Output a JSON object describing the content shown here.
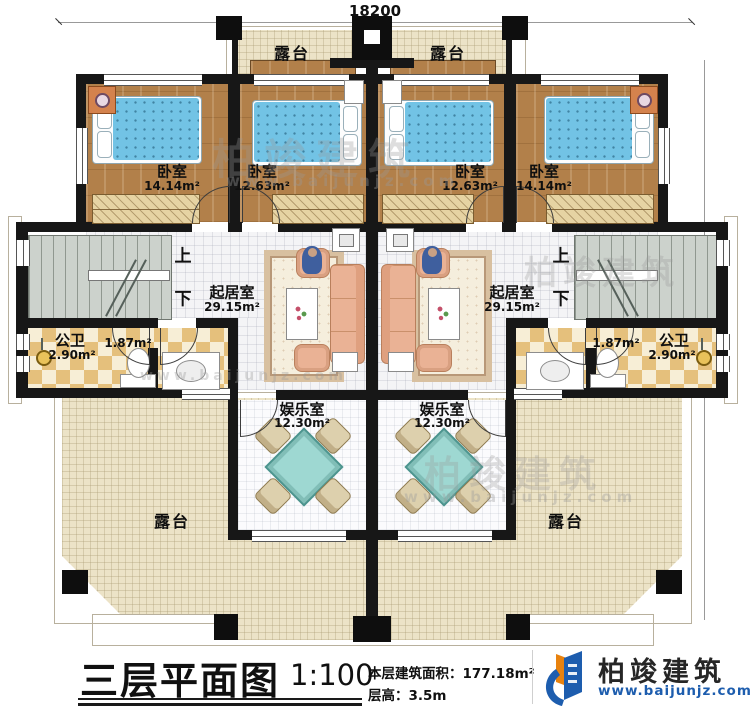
{
  "plan": {
    "dimensions": {
      "width_top": "18200",
      "height_right": "15840"
    },
    "stairs": {
      "up": "上",
      "down": "下"
    },
    "rooms": {
      "terrace": "露台",
      "bedroom_1": {
        "name": "卧室",
        "area": "14.14m²"
      },
      "bedroom_2": {
        "name": "卧室",
        "area": "12.63m²"
      },
      "bedroom_3": {
        "name": "卧室",
        "area": "12.63m²"
      },
      "bedroom_4": {
        "name": "卧室",
        "area": "14.14m²"
      },
      "living_left": {
        "name": "起居室",
        "area": "29.15m²"
      },
      "living_right": {
        "name": "起居室",
        "area": "29.15m²"
      },
      "bath_left": {
        "name": "公卫",
        "area": "2.90m²"
      },
      "bath_right": {
        "name": "公卫",
        "area": "2.90m²"
      },
      "wash_left": {
        "area": "1.87m²"
      },
      "wash_right": {
        "area": "1.87m²"
      },
      "game_left": {
        "name": "娱乐室",
        "area": "12.30m²"
      },
      "game_right": {
        "name": "娱乐室",
        "area": "12.30m²"
      }
    }
  },
  "title_block": {
    "title": "三层平面图",
    "scale": "1:100",
    "area_note": "本层建筑面积：177.18m²",
    "floor_height_note": "层高：3.5m"
  },
  "logo": {
    "brand": "柏竣建筑",
    "website": "www.baijunjz.com"
  },
  "watermark": {
    "brand": "柏竣建筑",
    "website": "www.baijunjz.com"
  },
  "colors": {
    "wall": "#171717",
    "terrace": "#ece3c7",
    "wood": "#b2804a",
    "stairs": "#ccd2cc",
    "tile_dark": "#e5c07c",
    "tile_light": "#f7eed6",
    "bed": "#72c3e5",
    "sofa": "#eab295",
    "game_table": "#9ed8d2",
    "logo_blue": "#1d5dae",
    "logo_orange": "#e8820e"
  }
}
